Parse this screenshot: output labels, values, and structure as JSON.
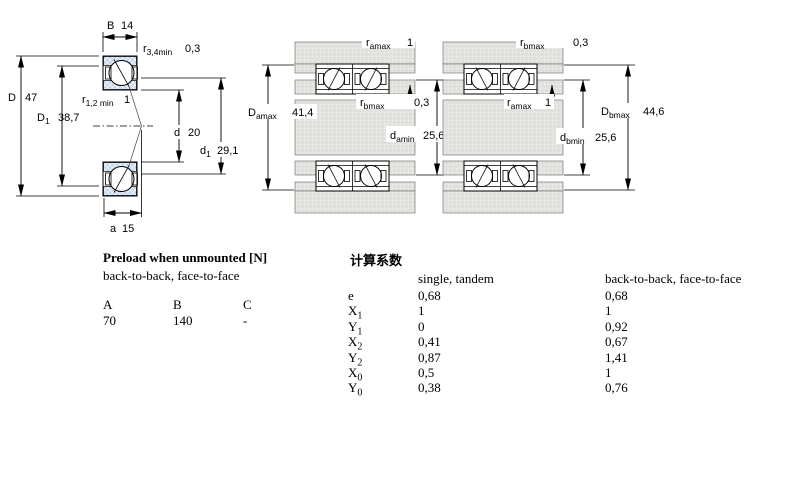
{
  "colors": {
    "ring_blue": "#c3d4ea",
    "metal_gray": "#e2e2de",
    "line": "#000000"
  },
  "left": {
    "B": {
      "sym": "B",
      "value": "14"
    },
    "r34": {
      "sym": "r",
      "sub": "3,4min",
      "value": "0,3"
    },
    "D": {
      "sym": "D",
      "value": "47"
    },
    "D1": {
      "sym": "D",
      "sub": "1",
      "value": "38,7"
    },
    "r12": {
      "sym": "r",
      "sub": "1,2 min",
      "value": "1"
    },
    "d": {
      "sym": "d",
      "value": "20"
    },
    "d1": {
      "sym": "d",
      "sub": "1",
      "value": "29,1"
    },
    "a": {
      "sym": "a",
      "value": "15"
    }
  },
  "middle": {
    "r_amax": {
      "sym": "r",
      "sub": "amax",
      "value": "1"
    },
    "D_amax": {
      "sym": "D",
      "sub": "amax",
      "value": "41,4"
    },
    "r_bmax": {
      "sym": "r",
      "sub": "bmax",
      "value": "0,3"
    },
    "d_amin": {
      "sym": "d",
      "sub": "amin",
      "value": "25,6"
    }
  },
  "right": {
    "r_bmax": {
      "sym": "r",
      "sub": "bmax",
      "value": "0,3"
    },
    "r_amax": {
      "sym": "r",
      "sub": "amax",
      "value": "1"
    },
    "D_bmax": {
      "sym": "D",
      "sub": "bmax",
      "value": "44,6"
    },
    "d_bmin": {
      "sym": "d",
      "sub": "bmin",
      "value": "25,6"
    }
  },
  "preload": {
    "title": "Preload when unmounted [N]",
    "subtitle": "back-to-back, face-to-face",
    "columns": [
      "A",
      "B",
      "C"
    ],
    "values": [
      "70",
      "140",
      "-"
    ]
  },
  "factors": {
    "title": "计算系数",
    "col_single": "single, tandem",
    "col_btb": "back-to-back, face-to-face",
    "rows": [
      {
        "sym": "e",
        "sub": "",
        "single": "0,68",
        "btb": "0,68"
      },
      {
        "sym": "X",
        "sub": "1",
        "single": "1",
        "btb": "1"
      },
      {
        "sym": "Y",
        "sub": "1",
        "single": "0",
        "btb": "0,92"
      },
      {
        "sym": "X",
        "sub": "2",
        "single": "0,41",
        "btb": "0,67"
      },
      {
        "sym": "Y",
        "sub": "2",
        "single": "0,87",
        "btb": "1,41"
      },
      {
        "sym": "X",
        "sub": "0",
        "single": "0,5",
        "btb": "1"
      },
      {
        "sym": "Y",
        "sub": "0",
        "single": "0,38",
        "btb": "0,76"
      }
    ]
  }
}
